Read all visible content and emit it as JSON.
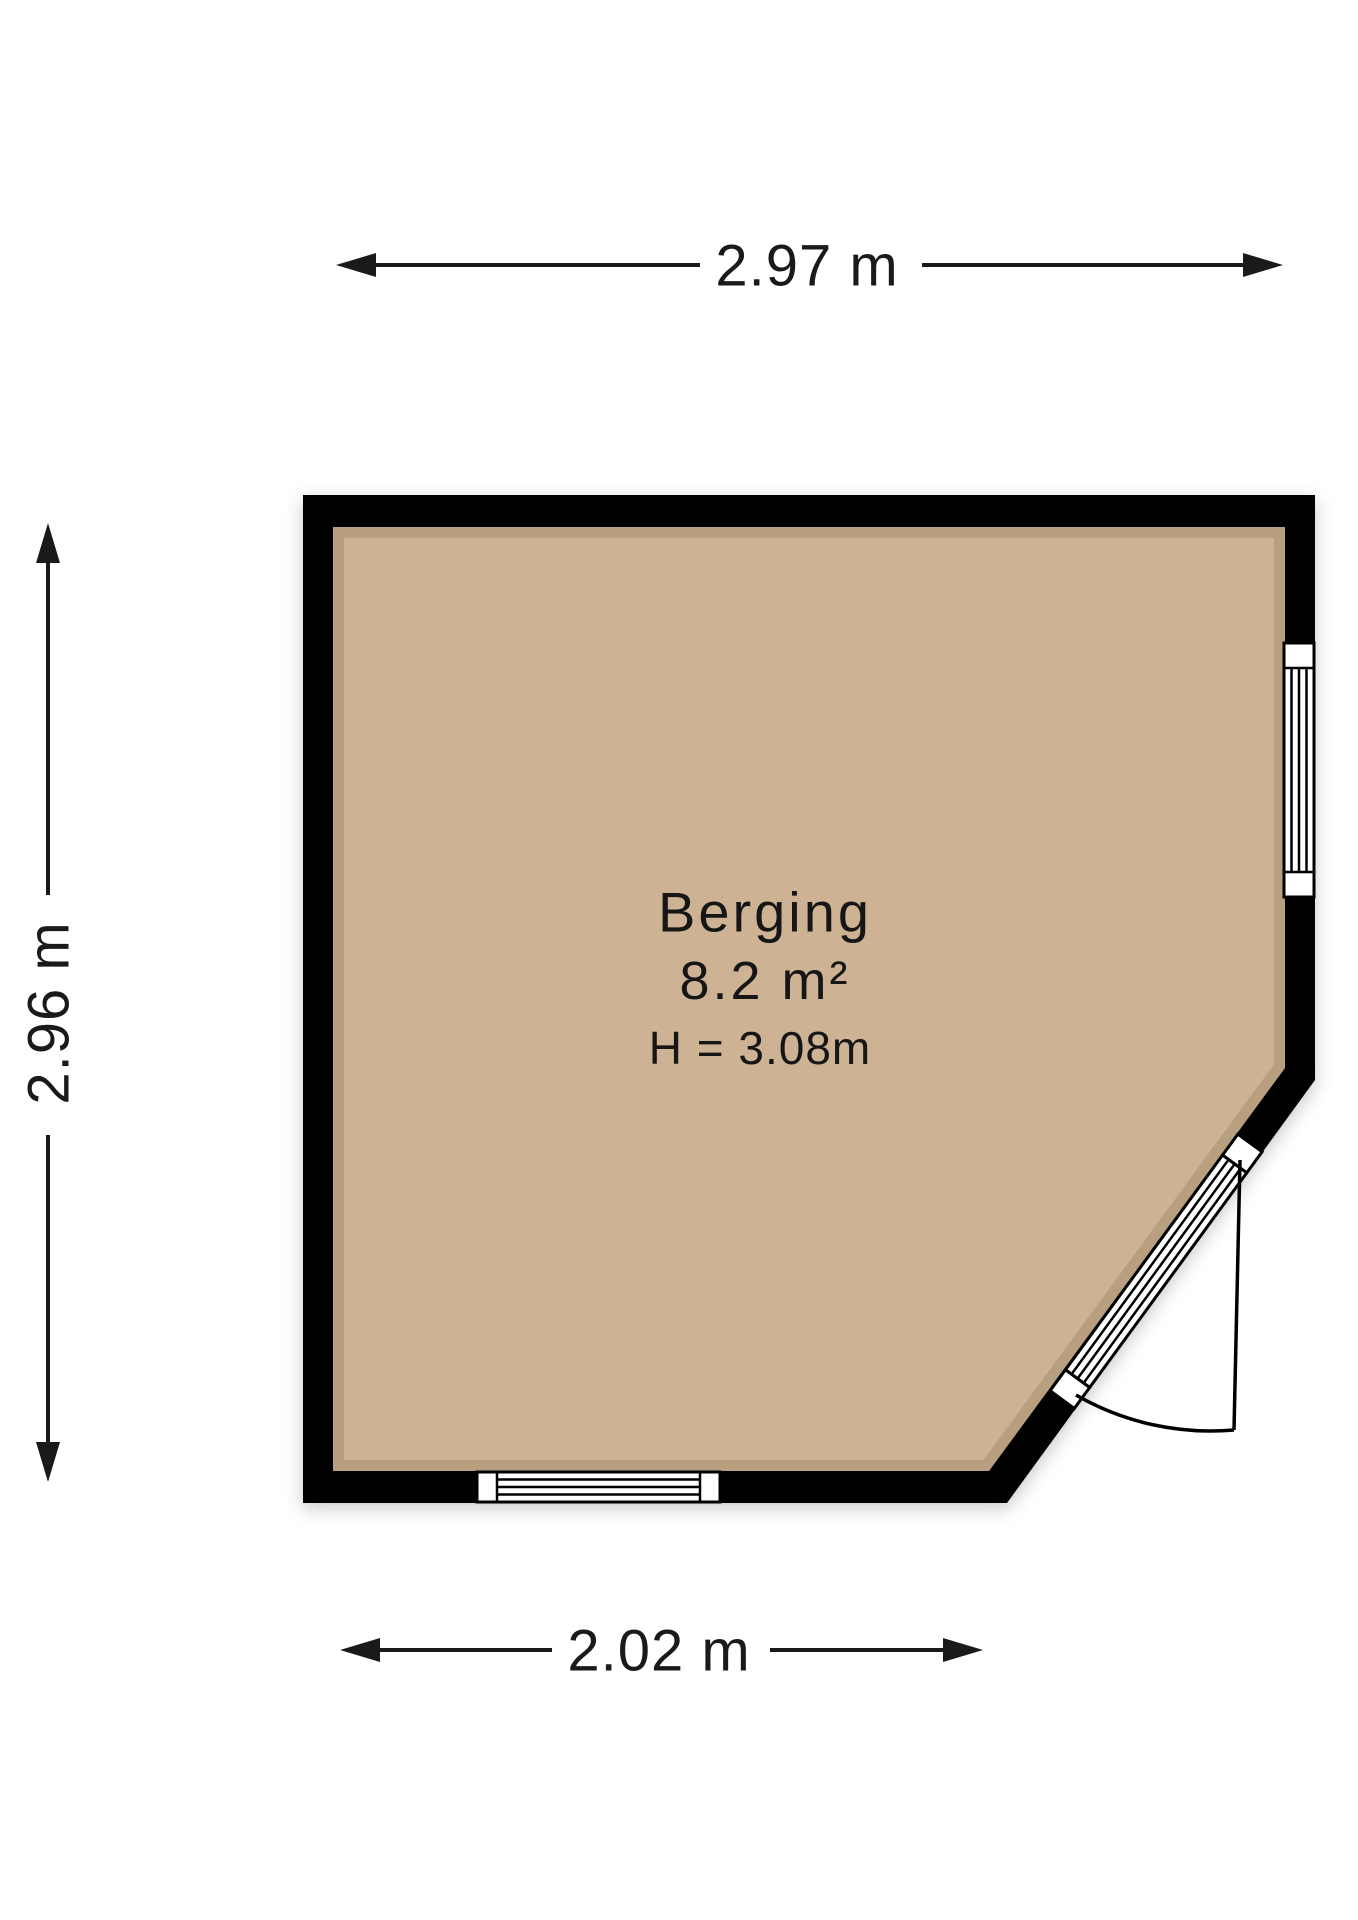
{
  "floorplan": {
    "room": {
      "name": "Berging",
      "area": "8.2 m²",
      "ceiling_height": "H = 3.08m"
    },
    "dimensions": {
      "top": "2.97 m",
      "left": "2.96 m",
      "bottom": "2.02 m"
    },
    "colors": {
      "floor": "#cdb394",
      "wall": "#000000",
      "text": "#1a1a1a",
      "background": "#ffffff"
    }
  }
}
